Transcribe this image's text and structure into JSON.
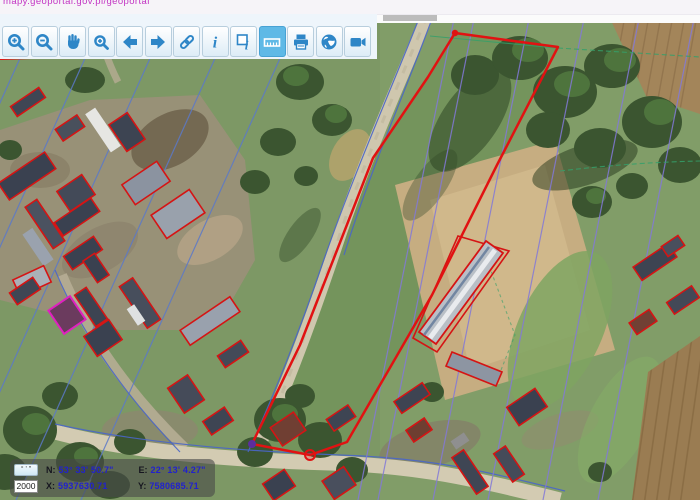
{
  "browser": {
    "url_text": "mapy.geoportal.gov.pl/geoportal"
  },
  "toolbar": {
    "active_tool": "measure",
    "buttons": [
      {
        "name": "zoom-in",
        "icon": "zoom-in-icon"
      },
      {
        "name": "zoom-out",
        "icon": "zoom-out-icon"
      },
      {
        "name": "pan",
        "icon": "pan-hand-icon"
      },
      {
        "name": "zoom-selection",
        "icon": "zoom-selection-icon"
      },
      {
        "name": "previous-view",
        "icon": "back-arrow-icon"
      },
      {
        "name": "next-view",
        "icon": "forward-arrow-icon"
      },
      {
        "name": "link",
        "icon": "link-icon"
      },
      {
        "name": "info",
        "icon": "info-icon"
      },
      {
        "name": "identify",
        "icon": "identify-icon"
      },
      {
        "name": "measure",
        "icon": "measure-ruler-icon",
        "active": true
      },
      {
        "name": "print",
        "icon": "printer-icon"
      },
      {
        "name": "world",
        "icon": "globe-icon"
      },
      {
        "name": "snapshot",
        "icon": "video-camera-icon"
      }
    ]
  },
  "coords_panel": {
    "dms_button_label": "° ' \"",
    "scale_value": "2000",
    "n_label": "N:",
    "n_value": "53° 33' 50.7\"",
    "e_label": "E:",
    "e_value": "22° 13' 4.27\"",
    "x_label": "X:",
    "x_value": "5937630.71",
    "y_label": "Y:",
    "y_value": "7580685.71"
  },
  "map": {
    "parcel_outline_color": "#e11212",
    "selected_building_outline_color": "#e020c0",
    "cadastral_line_blue": "#5b79c9",
    "cadastral_line_purple": "#8379d8",
    "boundary_line_teal": "#35a06b",
    "vertex_marker_purple": "#5c2d9e",
    "vertex_marker_red": "#e11212"
  },
  "colors": {
    "toolbar_icon": "#2e86c7",
    "active_tool_bg": "#5fb9e6",
    "coord_value_blue": "#2222cc",
    "url_text": "#c335c3"
  }
}
